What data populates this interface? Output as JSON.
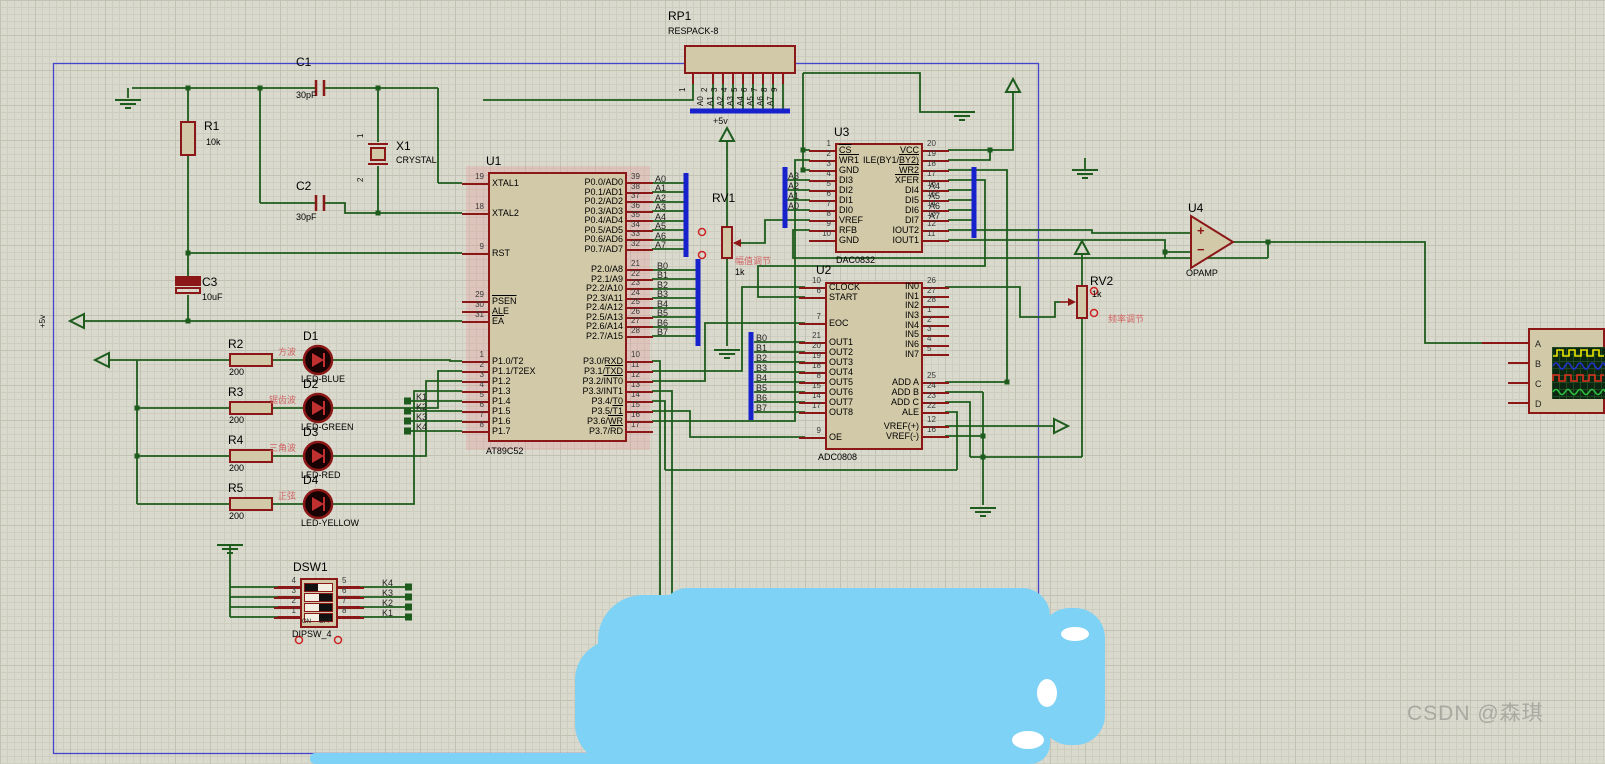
{
  "watermark": "CSDN @森琪",
  "colors": {
    "wire": "#1d5c1d",
    "bus": "#1822cc",
    "symbol": "#8b1717",
    "chip_fill": "#d2c9a8",
    "annotation_red": "#d06565",
    "scribble": "#7dd2f6",
    "sheet_border": "#4444cc"
  },
  "components": {
    "u1": {
      "p0": [
        {
          "n": "39",
          "name": "P0.0/AD0"
        },
        {
          "n": "38",
          "name": "P0.1/AD1"
        },
        {
          "n": "37",
          "name": "P0.2/AD2"
        },
        {
          "n": "36",
          "name": "P0.3/AD3"
        },
        {
          "n": "35",
          "name": "P0.4/AD4"
        },
        {
          "n": "34",
          "name": "P0.5/AD5"
        },
        {
          "n": "33",
          "name": "P0.6/AD6"
        },
        {
          "n": "32",
          "name": "P0.7/AD7"
        }
      ],
      "p2": [
        {
          "n": "21",
          "name": "P2.0/A8"
        },
        {
          "n": "22",
          "name": "P2.1/A9"
        },
        {
          "n": "23",
          "name": "P2.2/A10"
        },
        {
          "n": "24",
          "name": "P2.3/A11"
        },
        {
          "n": "25",
          "name": "P2.4/A12"
        },
        {
          "n": "26",
          "name": "P2.5/A13"
        },
        {
          "n": "27",
          "name": "P2.6/A14"
        },
        {
          "n": "28",
          "name": "P2.7/A15"
        }
      ],
      "p3": [
        {
          "n": "10",
          "name": "P3.0/RXD"
        },
        {
          "n": "11",
          "pre": "P3.1/",
          "bar": "TXD"
        },
        {
          "n": "12",
          "pre": "P3.2/",
          "bar": "INT0"
        },
        {
          "n": "13",
          "name": "P3.3/INT1"
        },
        {
          "n": "14",
          "name": "P3.4/T0"
        },
        {
          "n": "15",
          "pre": "P3.5/",
          "bar": "T1"
        },
        {
          "n": "16",
          "pre": "P3.6/",
          "bar": "WR"
        },
        {
          "n": "17",
          "pre": "P3.7/",
          "bar": "RD"
        }
      ],
      "xtal1": [
        {
          "n": "19",
          "name": "XTAL1"
        }
      ],
      "xtal2": [
        {
          "n": "18",
          "name": "XTAL2"
        }
      ],
      "rst": [
        {
          "n": "9",
          "name": "RST"
        }
      ],
      "ctrl": [
        {
          "n": "29",
          "bar": "PSEN"
        },
        {
          "n": "30",
          "name": "ALE"
        },
        {
          "n": "31",
          "bar": "EA"
        }
      ],
      "p1": [
        {
          "n": "1",
          "name": "P1.0/T2"
        },
        {
          "n": "2",
          "name": "P1.1/T2EX"
        },
        {
          "n": "3",
          "name": "P1.2"
        },
        {
          "n": "4",
          "name": "P1.3"
        },
        {
          "n": "5",
          "name": "P1.4"
        },
        {
          "n": "6",
          "name": "P1.5"
        },
        {
          "n": "7",
          "name": "P1.6"
        },
        {
          "n": "8",
          "name": "P1.7"
        }
      ]
    },
    "u3": {
      "left": [
        {
          "n": "1",
          "bar": "CS"
        },
        {
          "n": "2",
          "bar": "WR1"
        },
        {
          "n": "3",
          "name": "GND"
        },
        {
          "n": "4",
          "name": "DI3"
        },
        {
          "n": "5",
          "name": "DI2"
        },
        {
          "n": "6",
          "name": "DI1"
        },
        {
          "n": "7",
          "name": "DI0"
        },
        {
          "n": "8",
          "name": "VREF"
        },
        {
          "n": "9",
          "name": "RFB"
        },
        {
          "n": "10",
          "name": "GND"
        }
      ],
      "right": [
        {
          "n": "20",
          "name": "VCC"
        },
        {
          "n": "19",
          "pre": "ILE(BY1/",
          "bar": "BY2)"
        },
        {
          "n": "18",
          "bar": "WR2"
        },
        {
          "n": "17",
          "bar": "XFER"
        },
        {
          "n": "16",
          "name": "DI4"
        },
        {
          "n": "15",
          "name": "DI5"
        },
        {
          "n": "14",
          "name": "DI6"
        },
        {
          "n": "13",
          "name": "DI7"
        },
        {
          "n": "12",
          "name": "IOUT2"
        },
        {
          "n": "11",
          "name": "IOUT1"
        }
      ]
    },
    "u2": {
      "clk": [
        {
          "n": "10",
          "name": "CLOCK"
        },
        {
          "n": "6",
          "name": "START"
        }
      ],
      "eoc": [
        {
          "n": "7",
          "name": "EOC"
        }
      ],
      "out": [
        {
          "n": "21",
          "name": "OUT1"
        },
        {
          "n": "20",
          "name": "OUT2"
        },
        {
          "n": "19",
          "name": "OUT3"
        },
        {
          "n": "18",
          "name": "OUT4"
        },
        {
          "n": "8",
          "name": "OUT5"
        },
        {
          "n": "15",
          "name": "OUT6"
        },
        {
          "n": "14",
          "name": "OUT7"
        },
        {
          "n": "17",
          "name": "OUT8"
        }
      ],
      "oe": [
        {
          "n": "9",
          "name": "OE"
        }
      ],
      "in": [
        {
          "n": "26",
          "name": "IN0"
        },
        {
          "n": "27",
          "name": "IN1"
        },
        {
          "n": "28",
          "name": "IN2"
        },
        {
          "n": "1",
          "name": "IN3"
        },
        {
          "n": "2",
          "name": "IN4"
        },
        {
          "n": "3",
          "name": "IN5"
        },
        {
          "n": "4",
          "name": "IN6"
        },
        {
          "n": "5",
          "name": "IN7"
        }
      ],
      "add": [
        {
          "n": "25",
          "name": "ADD A"
        },
        {
          "n": "24",
          "name": "ADD B"
        },
        {
          "n": "23",
          "name": "ADD C"
        },
        {
          "n": "22",
          "name": "ALE"
        }
      ],
      "vref": [
        {
          "n": "12",
          "name": "VREF(+)"
        },
        {
          "n": "16",
          "name": "VREF(-)"
        }
      ]
    },
    "dsw1": {
      "left": [
        {
          "n": "4"
        },
        {
          "n": "3"
        },
        {
          "n": "2"
        },
        {
          "n": "1"
        }
      ],
      "right": [
        {
          "n": "5"
        },
        {
          "n": "6"
        },
        {
          "n": "7"
        },
        {
          "n": "8"
        }
      ],
      "rockers": [
        {
          "c": "on"
        },
        {
          "c": "off"
        },
        {
          "c": "off"
        },
        {
          "c": "off"
        }
      ]
    },
    "scope": {
      "channels": [
        {
          "t": "A"
        },
        {
          "t": "B"
        },
        {
          "t": "C"
        },
        {
          "t": "D"
        }
      ]
    }
  },
  "labels": [
    {
      "t": "C1",
      "x": 296,
      "y": 56,
      "c": "ref"
    },
    {
      "t": "30pF",
      "x": 296,
      "y": 90,
      "c": "val"
    },
    {
      "t": "C2",
      "x": 296,
      "y": 180,
      "c": "ref"
    },
    {
      "t": "30pF",
      "x": 296,
      "y": 212,
      "c": "val"
    },
    {
      "t": "C3",
      "x": 202,
      "y": 276,
      "c": "ref"
    },
    {
      "t": "10uF",
      "x": 202,
      "y": 292,
      "c": "val"
    },
    {
      "t": "R1",
      "x": 204,
      "y": 120,
      "c": "ref"
    },
    {
      "t": "10k",
      "x": 206,
      "y": 137,
      "c": "val"
    },
    {
      "t": "X1",
      "x": 396,
      "y": 140,
      "c": "ref"
    },
    {
      "t": "CRYSTAL",
      "x": 396,
      "y": 155,
      "c": "val"
    },
    {
      "t": "U1",
      "x": 486,
      "y": 155,
      "c": "ref"
    },
    {
      "t": "AT89C52",
      "x": 486,
      "y": 446,
      "c": "val"
    },
    {
      "t": "RP1",
      "x": 668,
      "y": 10,
      "c": "ref"
    },
    {
      "t": "RESPACK-8",
      "x": 668,
      "y": 26,
      "c": "val"
    },
    {
      "t": "U3",
      "x": 834,
      "y": 126,
      "c": "ref"
    },
    {
      "t": "DAC0832",
      "x": 836,
      "y": 255,
      "c": "val"
    },
    {
      "t": "U2",
      "x": 816,
      "y": 264,
      "c": "ref"
    },
    {
      "t": "ADC0808",
      "x": 818,
      "y": 452,
      "c": "val"
    },
    {
      "t": "U4",
      "x": 1188,
      "y": 202,
      "c": "ref"
    },
    {
      "t": "OPAMP",
      "x": 1186,
      "y": 268,
      "c": "val"
    },
    {
      "t": "RV1",
      "x": 712,
      "y": 192,
      "c": "ref"
    },
    {
      "t": "1k",
      "x": 735,
      "y": 267,
      "c": "val"
    },
    {
      "t": "RV2",
      "x": 1090,
      "y": 275,
      "c": "ref"
    },
    {
      "t": "1k",
      "x": 1092,
      "y": 289,
      "c": "val"
    },
    {
      "t": "DSW1",
      "x": 293,
      "y": 561,
      "c": "ref"
    },
    {
      "t": "DIPSW_4",
      "x": 292,
      "y": 629,
      "c": "val"
    },
    {
      "t": "D1",
      "x": 303,
      "y": 330,
      "c": "ref"
    },
    {
      "t": "LED-BLUE",
      "x": 301,
      "y": 374,
      "c": "val"
    },
    {
      "t": "D2",
      "x": 303,
      "y": 378,
      "c": "ref"
    },
    {
      "t": "LED-GREEN",
      "x": 301,
      "y": 422,
      "c": "val"
    },
    {
      "t": "D3",
      "x": 303,
      "y": 426,
      "c": "ref"
    },
    {
      "t": "LED-RED",
      "x": 301,
      "y": 470,
      "c": "val"
    },
    {
      "t": "D4",
      "x": 303,
      "y": 474,
      "c": "ref"
    },
    {
      "t": "LED-YELLOW",
      "x": 301,
      "y": 518,
      "c": "val"
    },
    {
      "t": "R2",
      "x": 228,
      "y": 338,
      "c": "ref"
    },
    {
      "t": "200",
      "x": 229,
      "y": 367,
      "c": "val"
    },
    {
      "t": "R3",
      "x": 228,
      "y": 386,
      "c": "ref"
    },
    {
      "t": "200",
      "x": 229,
      "y": 415,
      "c": "val"
    },
    {
      "t": "R4",
      "x": 228,
      "y": 434,
      "c": "ref"
    },
    {
      "t": "200",
      "x": 229,
      "y": 463,
      "c": "val"
    },
    {
      "t": "R5",
      "x": 228,
      "y": 482,
      "c": "ref"
    },
    {
      "t": "200",
      "x": 229,
      "y": 511,
      "c": "val"
    },
    {
      "t": "方波",
      "x": 278,
      "y": 347,
      "c": "red"
    },
    {
      "t": "锯齿波",
      "x": 269,
      "y": 395,
      "c": "red"
    },
    {
      "t": "三角波",
      "x": 269,
      "y": 443,
      "c": "red"
    },
    {
      "t": "正弦",
      "x": 278,
      "y": 491,
      "c": "red"
    },
    {
      "t": "幅值调节",
      "x": 735,
      "y": 256,
      "c": "red"
    },
    {
      "t": "频率调节",
      "x": 1108,
      "y": 314,
      "c": "red"
    },
    {
      "t": "A0",
      "x": 655,
      "y": 174,
      "c": "net"
    },
    {
      "t": "A1",
      "x": 655,
      "y": 183,
      "c": "net"
    },
    {
      "t": "A2",
      "x": 655,
      "y": 193,
      "c": "net"
    },
    {
      "t": "A3",
      "x": 655,
      "y": 202,
      "c": "net"
    },
    {
      "t": "A4",
      "x": 655,
      "y": 212,
      "c": "net"
    },
    {
      "t": "A5",
      "x": 655,
      "y": 221,
      "c": "net"
    },
    {
      "t": "A6",
      "x": 655,
      "y": 231,
      "c": "net"
    },
    {
      "t": "A7",
      "x": 655,
      "y": 240,
      "c": "net"
    },
    {
      "t": "B0",
      "x": 657,
      "y": 261,
      "c": "net"
    },
    {
      "t": "B1",
      "x": 657,
      "y": 270,
      "c": "net"
    },
    {
      "t": "B2",
      "x": 657,
      "y": 280,
      "c": "net"
    },
    {
      "t": "B3",
      "x": 657,
      "y": 289,
      "c": "net"
    },
    {
      "t": "B4",
      "x": 657,
      "y": 299,
      "c": "net"
    },
    {
      "t": "B5",
      "x": 657,
      "y": 308,
      "c": "net"
    },
    {
      "t": "B6",
      "x": 657,
      "y": 318,
      "c": "net"
    },
    {
      "t": "B7",
      "x": 657,
      "y": 327,
      "c": "net"
    },
    {
      "t": "A3",
      "x": 788,
      "y": 171,
      "c": "net"
    },
    {
      "t": "A2",
      "x": 788,
      "y": 181,
      "c": "net"
    },
    {
      "t": "A1",
      "x": 788,
      "y": 191,
      "c": "net"
    },
    {
      "t": "A0",
      "x": 788,
      "y": 201,
      "c": "net"
    },
    {
      "t": "A4",
      "x": 929,
      "y": 181,
      "c": "net"
    },
    {
      "t": "A5",
      "x": 929,
      "y": 191,
      "c": "net"
    },
    {
      "t": "A6",
      "x": 929,
      "y": 201,
      "c": "net"
    },
    {
      "t": "A7",
      "x": 929,
      "y": 211,
      "c": "net"
    },
    {
      "t": "B0",
      "x": 756,
      "y": 333,
      "c": "net"
    },
    {
      "t": "B1",
      "x": 756,
      "y": 343,
      "c": "net"
    },
    {
      "t": "B2",
      "x": 756,
      "y": 353,
      "c": "net"
    },
    {
      "t": "B3",
      "x": 756,
      "y": 363,
      "c": "net"
    },
    {
      "t": "B4",
      "x": 756,
      "y": 373,
      "c": "net"
    },
    {
      "t": "B5",
      "x": 756,
      "y": 383,
      "c": "net"
    },
    {
      "t": "B6",
      "x": 756,
      "y": 393,
      "c": "net"
    },
    {
      "t": "B7",
      "x": 756,
      "y": 403,
      "c": "net"
    },
    {
      "t": "K1",
      "x": 416,
      "y": 392,
      "c": "net"
    },
    {
      "t": "K2",
      "x": 416,
      "y": 402,
      "c": "net"
    },
    {
      "t": "K3",
      "x": 416,
      "y": 412,
      "c": "net"
    },
    {
      "t": "K4",
      "x": 416,
      "y": 422,
      "c": "net"
    },
    {
      "t": "K4",
      "x": 382,
      "y": 578,
      "c": "net"
    },
    {
      "t": "K3",
      "x": 382,
      "y": 588,
      "c": "net"
    },
    {
      "t": "K2",
      "x": 382,
      "y": 598,
      "c": "net"
    },
    {
      "t": "K1",
      "x": 382,
      "y": 608,
      "c": "net"
    },
    {
      "t": "+5v",
      "x": 713,
      "y": 116,
      "c": "pwr"
    },
    {
      "t": "+5v",
      "x": 48,
      "y": 318,
      "c": "vpwr"
    },
    {
      "t": "1",
      "x": 688,
      "y": 82,
      "c": "vnet"
    },
    {
      "t": "2",
      "x": 710,
      "y": 82,
      "c": "vnet"
    },
    {
      "t": "3",
      "x": 720,
      "y": 82,
      "c": "vnet"
    },
    {
      "t": "4",
      "x": 730,
      "y": 82,
      "c": "vnet"
    },
    {
      "t": "5",
      "x": 740,
      "y": 82,
      "c": "vnet"
    },
    {
      "t": "6",
      "x": 750,
      "y": 82,
      "c": "vnet"
    },
    {
      "t": "7",
      "x": 760,
      "y": 82,
      "c": "vnet"
    },
    {
      "t": "8",
      "x": 770,
      "y": 82,
      "c": "vnet"
    },
    {
      "t": "9",
      "x": 780,
      "y": 82,
      "c": "vnet"
    },
    {
      "t": "A0",
      "x": 706,
      "y": 96,
      "c": "vnet"
    },
    {
      "t": "A1",
      "x": 716,
      "y": 96,
      "c": "vnet"
    },
    {
      "t": "A2",
      "x": 726,
      "y": 96,
      "c": "vnet"
    },
    {
      "t": "A3",
      "x": 736,
      "y": 96,
      "c": "vnet"
    },
    {
      "t": "A4",
      "x": 746,
      "y": 96,
      "c": "vnet"
    },
    {
      "t": "A5",
      "x": 756,
      "y": 96,
      "c": "vnet"
    },
    {
      "t": "A6",
      "x": 766,
      "y": 96,
      "c": "vnet"
    },
    {
      "t": "A7",
      "x": 776,
      "y": 96,
      "c": "vnet"
    },
    {
      "t": "1",
      "x": 366,
      "y": 128,
      "c": "vnet"
    },
    {
      "t": "2",
      "x": 366,
      "y": 172,
      "c": "vnet"
    },
    {
      "t": "+",
      "x": 1197,
      "y": 224,
      "c": "opsym"
    },
    {
      "t": "−",
      "x": 1197,
      "y": 243,
      "c": "opsym"
    },
    {
      "t": "ON",
      "x": 302,
      "y": 619,
      "c": "tiny"
    },
    {
      "t": "OFF",
      "x": 319,
      "y": 619,
      "c": "tiny"
    }
  ]
}
